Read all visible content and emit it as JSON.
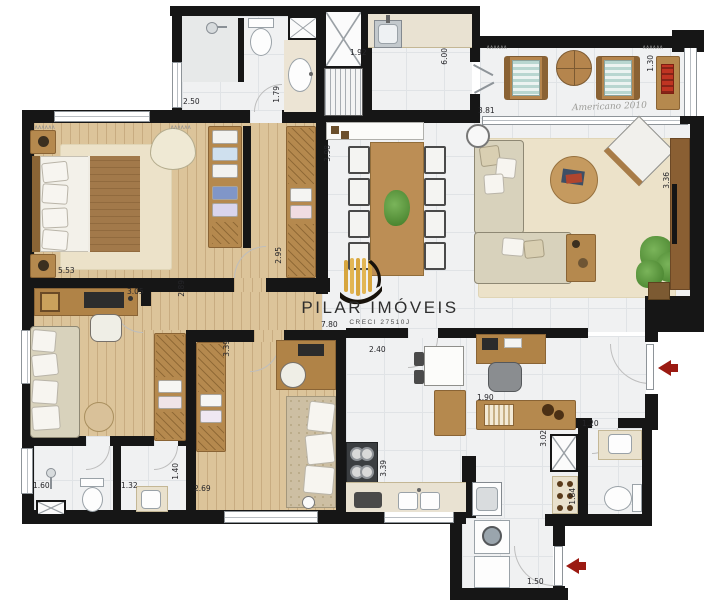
{
  "watermark": {
    "name": "PILAR IMÓVEIS",
    "creci": "CRECI 27510J"
  },
  "signature": "Americano 2010",
  "symbols": {
    "curtain": "∧∧∧∧∧∧"
  },
  "colors": {
    "wall": "#161616",
    "wood_floor": "#dcc49a",
    "tile_floor": "#f0f1f2",
    "arrow_red": "#9b1a12",
    "logo_gold": "#d7a63e"
  },
  "dims": [
    {
      "v": "2.50",
      "x": 183,
      "y": 97
    },
    {
      "v": "1.79",
      "x": 272,
      "y": 86,
      "vert": true
    },
    {
      "v": "1.92",
      "x": 350,
      "y": 48
    },
    {
      "v": "6.00",
      "x": 440,
      "y": 48,
      "vert": true
    },
    {
      "v": "3.81",
      "x": 478,
      "y": 106
    },
    {
      "v": "1.30",
      "x": 646,
      "y": 55,
      "vert": true
    },
    {
      "v": "3.98",
      "x": 323,
      "y": 145,
      "vert": true
    },
    {
      "v": "3.36",
      "x": 662,
      "y": 172,
      "vert": true
    },
    {
      "v": "5.53",
      "x": 58,
      "y": 266
    },
    {
      "v": "2.95",
      "x": 274,
      "y": 247,
      "vert": true
    },
    {
      "v": "3.05",
      "x": 127,
      "y": 287
    },
    {
      "v": "2.89",
      "x": 177,
      "y": 280,
      "vert": true
    },
    {
      "v": "3.39",
      "x": 222,
      "y": 340,
      "vert": true
    },
    {
      "v": "2.40",
      "x": 369,
      "y": 345
    },
    {
      "v": "1.90",
      "x": 477,
      "y": 393
    },
    {
      "v": "1.20",
      "x": 582,
      "y": 419
    },
    {
      "v": "3.02",
      "x": 539,
      "y": 430,
      "vert": true
    },
    {
      "v": "3.39",
      "x": 379,
      "y": 460,
      "vert": true
    },
    {
      "v": "2.69",
      "x": 194,
      "y": 484
    },
    {
      "v": "1.60",
      "x": 33,
      "y": 481
    },
    {
      "v": "1.32",
      "x": 121,
      "y": 481
    },
    {
      "v": "1.40",
      "x": 171,
      "y": 463,
      "vert": true
    },
    {
      "v": "1.84",
      "x": 568,
      "y": 488,
      "vert": true
    },
    {
      "v": "1.50",
      "x": 527,
      "y": 577
    },
    {
      "v": "7.80",
      "x": 321,
      "y": 320
    }
  ],
  "arrows": [
    {
      "x": 658,
      "y": 360
    },
    {
      "x": 566,
      "y": 558
    }
  ]
}
